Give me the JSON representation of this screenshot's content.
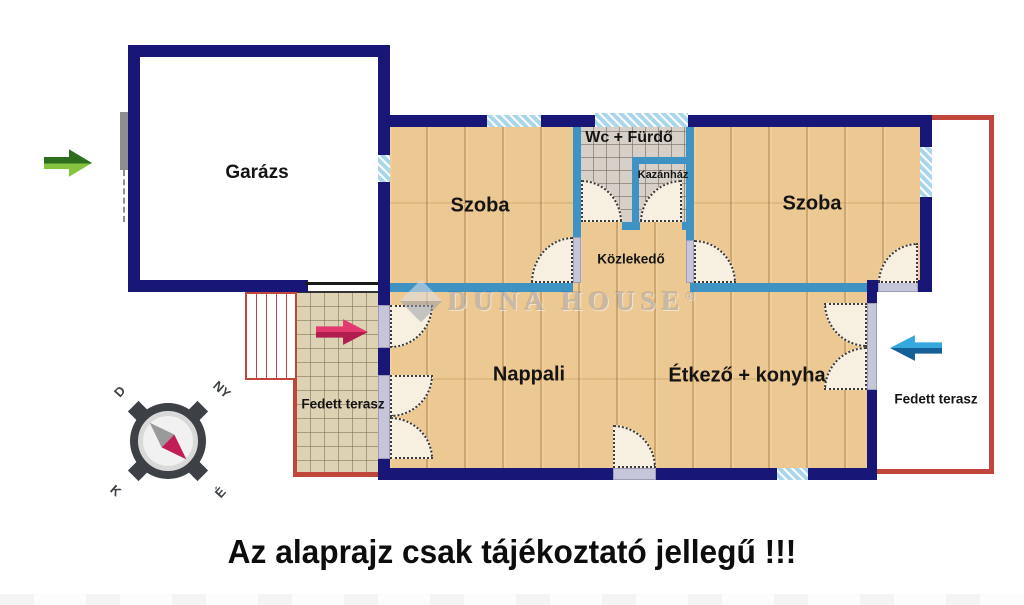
{
  "floor_plan": {
    "rooms": {
      "garage": {
        "label": "Garázs"
      },
      "bedroom_left": {
        "label": "Szoba"
      },
      "bedroom_right": {
        "label": "Szoba"
      },
      "bathroom": {
        "label": "Wc + Fürdő"
      },
      "boiler_room": {
        "label": "Kazánház"
      },
      "hallway": {
        "label": "Közlekedő"
      },
      "living_room": {
        "label": "Nappali"
      },
      "dining_kitchen": {
        "label": "Étkező + konyha"
      },
      "terrace_left": {
        "label": "Fedett terasz"
      },
      "terrace_right": {
        "label": "Fedett terasz"
      }
    },
    "compass": {
      "south_label": "D",
      "west_label": "NY",
      "east_label": "K",
      "north_label": "É"
    },
    "watermark": {
      "brand": "DUNA HOUSE",
      "mark": "®"
    },
    "disclaimer": "Az alaprajz csak tájékoztató jellegű !!!",
    "colors": {
      "exterior_wall": "#181778",
      "interior_wall": "#3f93c2",
      "wood_floor": "#ecc892",
      "bath_tile": "#d6d0c8",
      "terrace_tile": "#ddd2b4",
      "terrace_border": "#c0453a",
      "window": "#a9d6ec",
      "door_leaf_fill": "#f7efdf",
      "arrow_green": "#2c6e1d",
      "arrow_crimson": "#c92b5e",
      "arrow_blue": "#1c7fc0",
      "compass_needle_north": "#c21d56"
    }
  }
}
